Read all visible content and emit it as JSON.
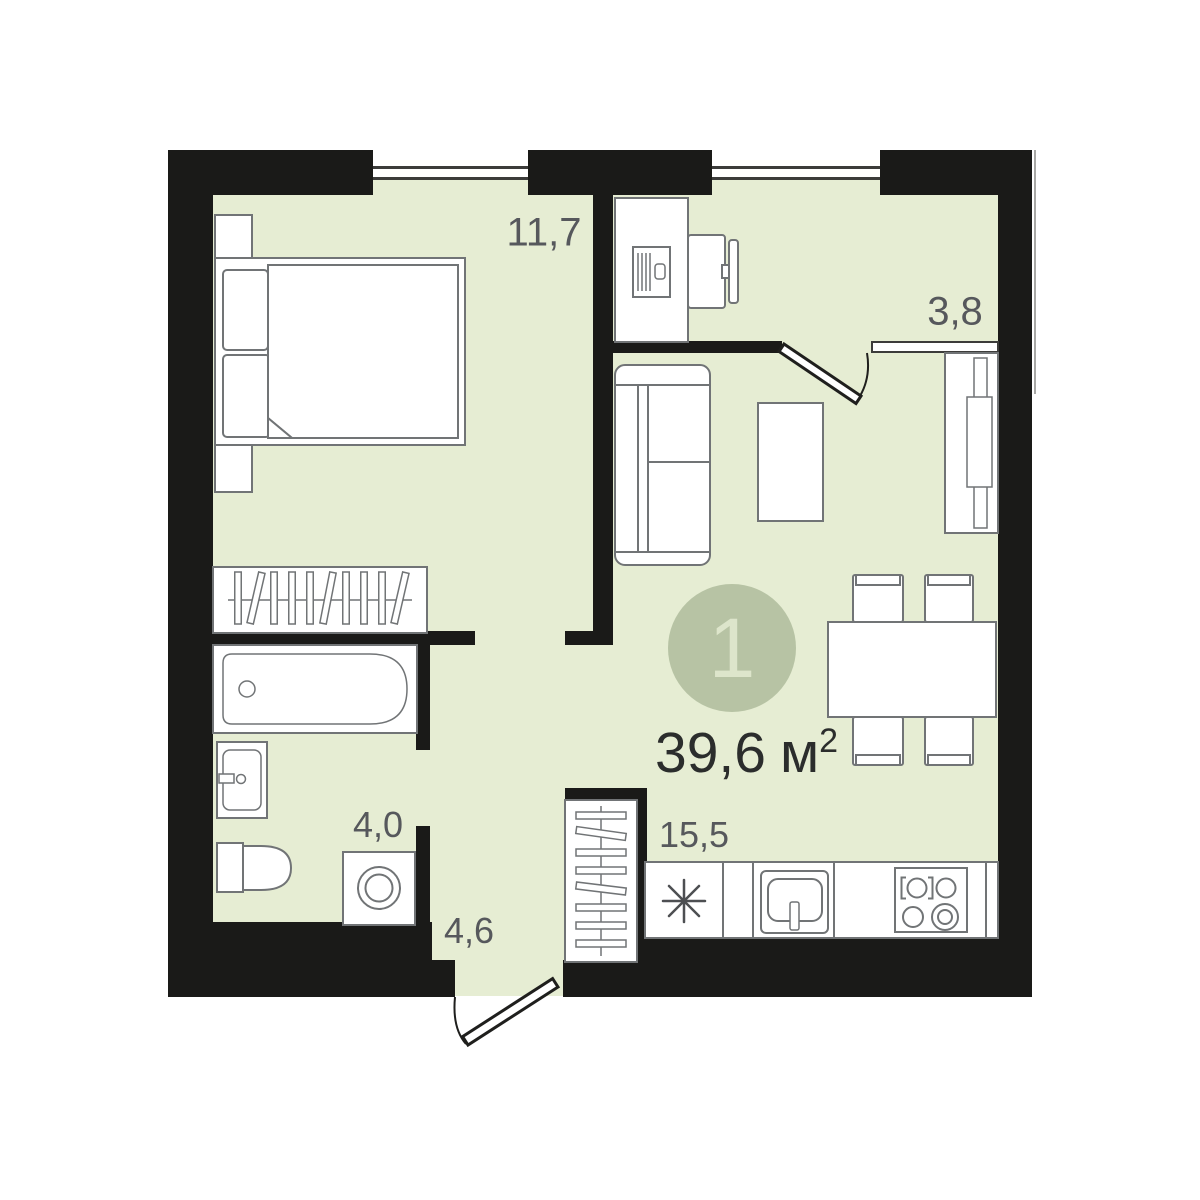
{
  "badge": {
    "number": "1"
  },
  "total_area": {
    "value": "39,6",
    "unit": "м",
    "superscript": "2"
  },
  "labels": {
    "bedroom": "11,7",
    "loggia": "3,8",
    "bathroom": "4,0",
    "hallway": "4,6",
    "kitchen_living": "15,5"
  },
  "colors": {
    "floor": "#e6edd3",
    "wall": "#1a1a18",
    "badge_fill": "#b7c3a4",
    "badge_number": "#dde5cb",
    "room_label": "#56585c",
    "area_text": "#2b2d2c",
    "furniture_stroke": "#717476",
    "window_line": "#3c3c3a",
    "door_stroke": "#1f1f1d"
  },
  "icons": [
    "double-bed",
    "pillow",
    "nightstand",
    "wardrobe-hangers",
    "clothes-rack",
    "bathtub",
    "washbasin",
    "toilet",
    "washing-machine",
    "desk",
    "desktop-computer",
    "office-chair",
    "sofa",
    "coffee-table",
    "tv-stand",
    "dining-table",
    "dining-chair",
    "fridge-asterisk",
    "kitchen-sink",
    "stove-4-burner",
    "entrance-door",
    "interior-door",
    "window"
  ]
}
